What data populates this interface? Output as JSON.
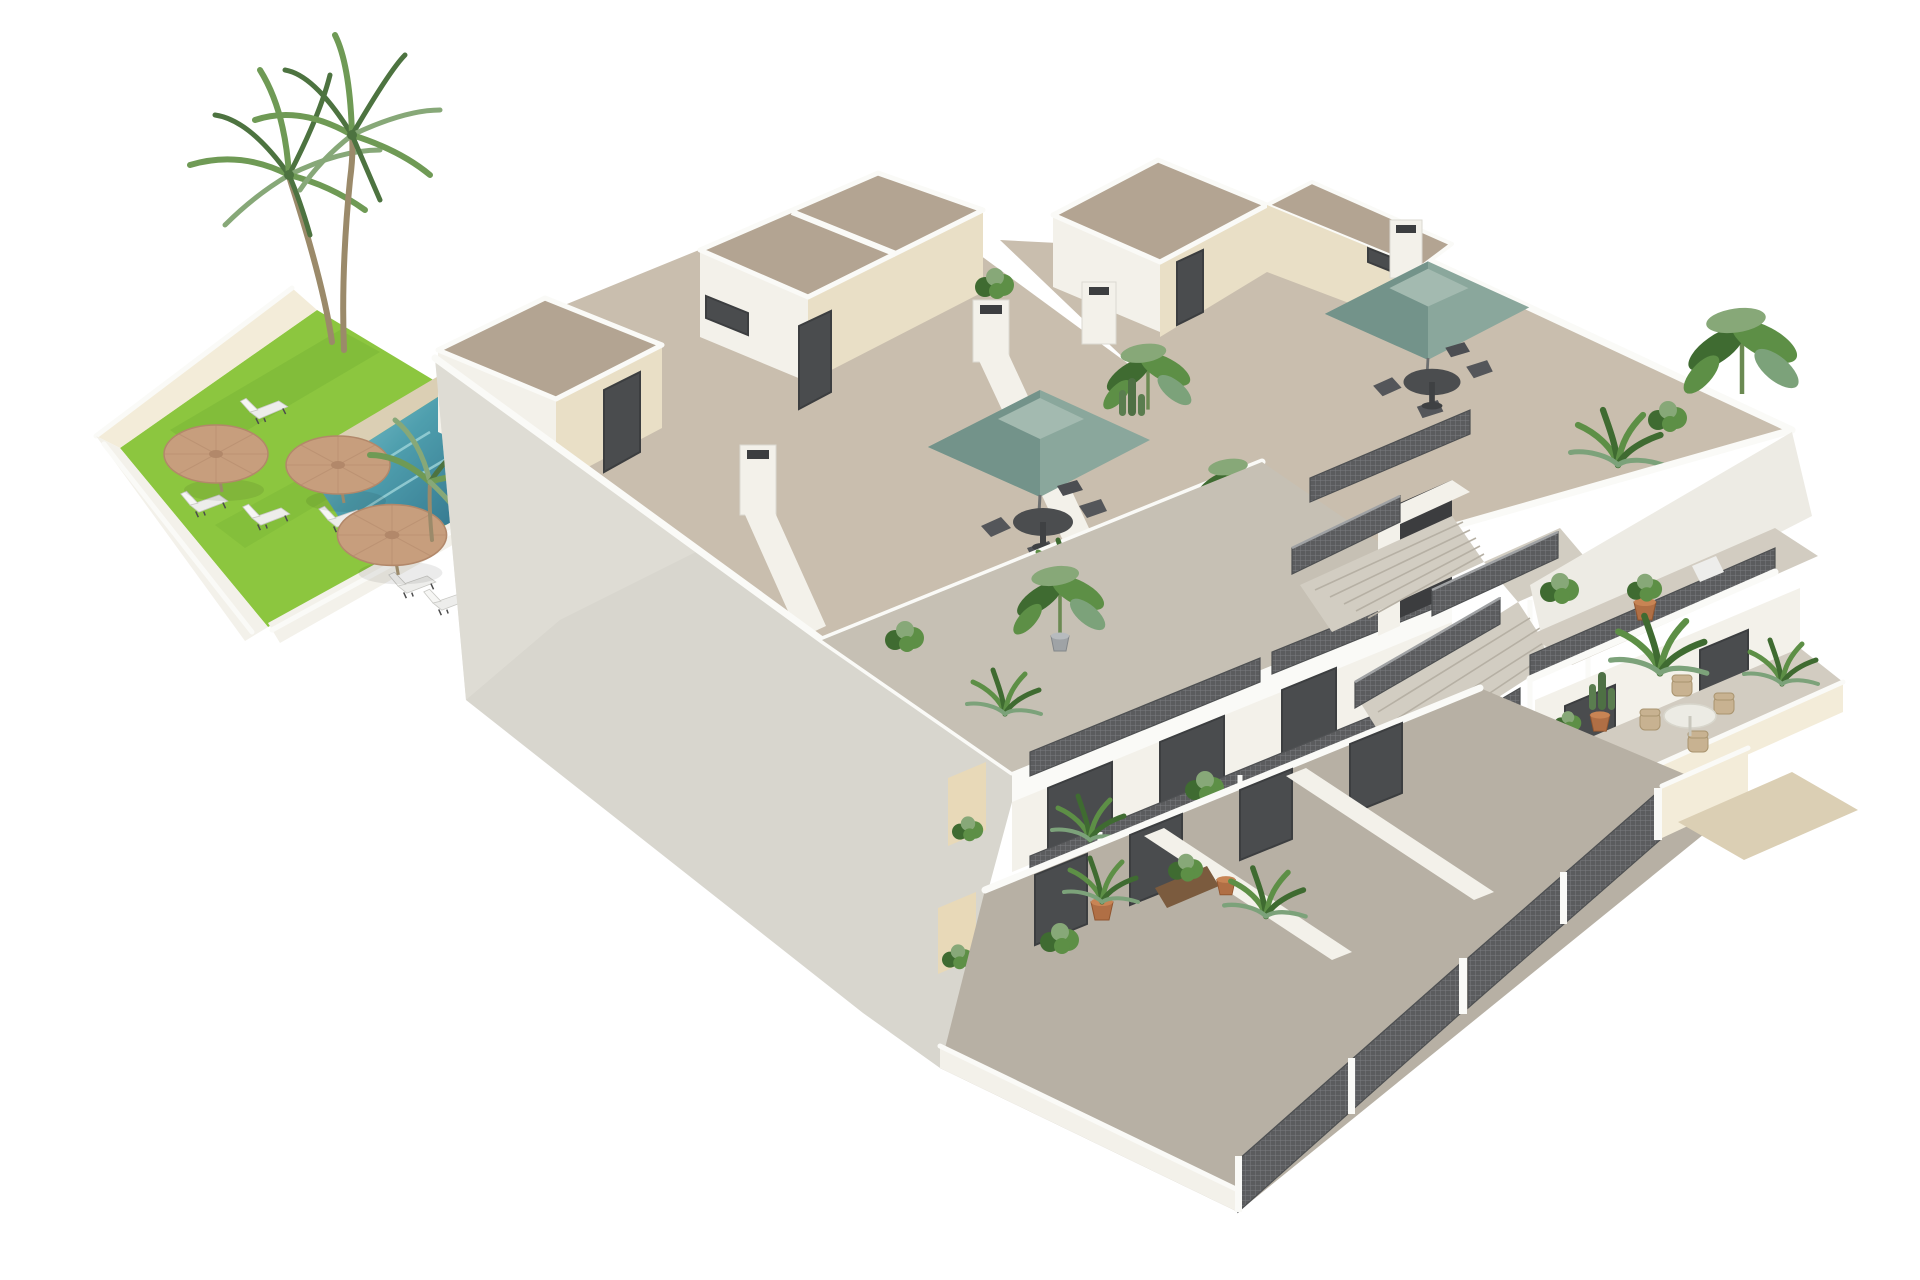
{
  "scene": {
    "type": "3d-architectural-render",
    "view": "isometric-cutaway",
    "subject": "two-storey apartment building with roof terraces, communal garden and swimming pool",
    "elements": [
      {
        "name": "communal-garden",
        "count": 1
      },
      {
        "name": "lawn",
        "count": 1
      },
      {
        "name": "swimming-pool",
        "count": 1
      },
      {
        "name": "pool-deck",
        "count": 1
      },
      {
        "name": "palm-tree",
        "count": 2
      },
      {
        "name": "straw-parasol",
        "count": 3
      },
      {
        "name": "sun-lounger",
        "count": 6
      },
      {
        "name": "stair-penthouse",
        "count": 4
      },
      {
        "name": "roof-terrace",
        "count": 2
      },
      {
        "name": "square-parasol",
        "count": 2
      },
      {
        "name": "outdoor-dining-set",
        "count": 3
      },
      {
        "name": "chimney",
        "count": 4
      },
      {
        "name": "central-staircase",
        "count": 1
      },
      {
        "name": "mesh-railing",
        "count": 8
      },
      {
        "name": "balcony",
        "count": 4
      },
      {
        "name": "ground-floor-patio",
        "count": 3
      },
      {
        "name": "perimeter-fence",
        "count": 3
      },
      {
        "name": "potted-plant",
        "count": 16
      },
      {
        "name": "entrance-walkway",
        "count": 1
      }
    ]
  },
  "colors": {
    "background": "#ffffff",
    "lawn": "#8cc63f",
    "lawnShade": "#76b135",
    "poolWater": "#4f9fae",
    "poolDeep": "#35788f",
    "poolLight": "#9fd4d9",
    "deck": "#dbcfb4",
    "sandWall": "#e9dfc6",
    "sandWallShade": "#d9cdae",
    "sandWallLight": "#f3ecd9",
    "whiteWall": "#f3f1ea",
    "whiteWallShade": "#e4e2da",
    "bigWall": "#d8d6ce",
    "parapetTop": "#fafaf7",
    "roofTop": "#b3a492",
    "roofFloor": "#c9beae",
    "terraceFloor": "#c6c0b4",
    "terraceFloorLight": "#d2ccc1",
    "groundFloor": "#b7b0a4",
    "teal": "#8aa79c",
    "tealDark": "#73938a",
    "tealLight": "#a3bab0",
    "strawUmbrella": "#c79e7d",
    "strawUmbrellaDark": "#b2886a",
    "mesh": "#5d5e5f",
    "meshLight": "#797b7d",
    "doorDark": "#4a4c4e",
    "frameDark": "#3c3e40",
    "plantGreen": "#5d8f46",
    "plantDark": "#3f6b31",
    "plantGray": "#7ca27a",
    "palmGreen": "#6f9a55",
    "palmDark": "#4d7340",
    "palmGray": "#87a878",
    "trunk": "#9b8a6a",
    "terracotta": "#b06f45",
    "stairConcrete": "#d2cdc2",
    "loungerWhite": "#ededeb",
    "tableDark": "#4b4d4f",
    "wicker": "#c8b291",
    "tableWhite": "#ecebe4",
    "warmNiche": "#e8d9b8"
  }
}
